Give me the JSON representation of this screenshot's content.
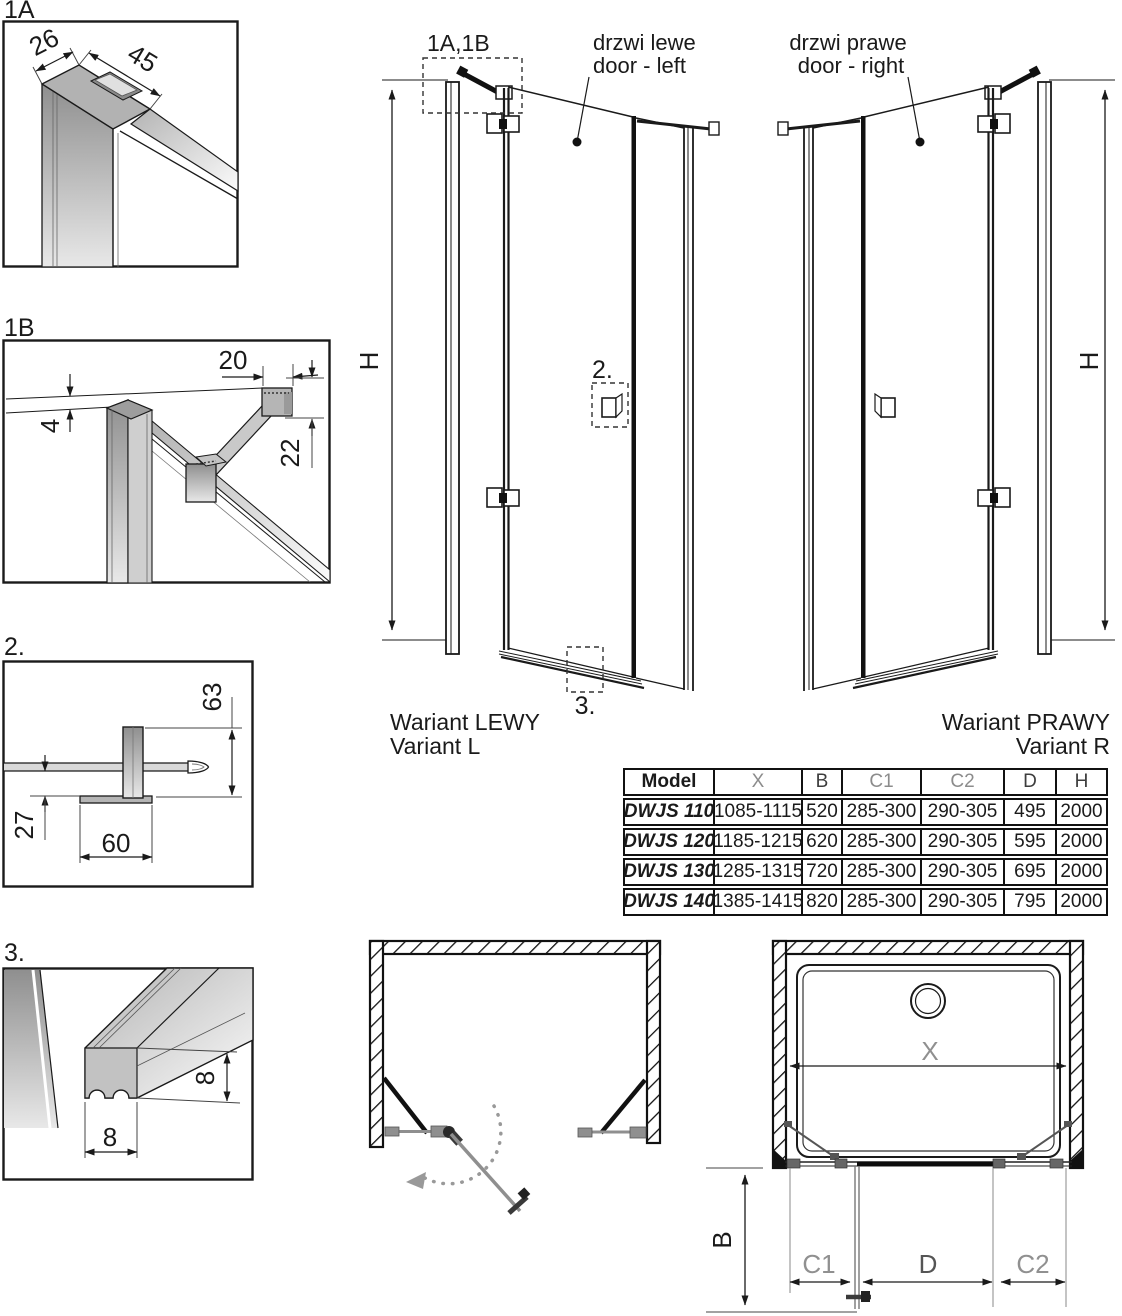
{
  "details": {
    "d1a": {
      "label": "1A",
      "dim_width": "26",
      "dim_depth": "45"
    },
    "d1b": {
      "label": "1B",
      "dim_top": "20",
      "dim_gap": "4",
      "dim_height": "22"
    },
    "d2": {
      "label": "2.",
      "dim_height": "63",
      "dim_offset": "27",
      "dim_width": "60"
    },
    "d3": {
      "label": "3.",
      "dim_height": "8",
      "dim_width": "8"
    }
  },
  "elevation_left": {
    "callout": "1A,1B",
    "door_label_line1": "drzwi lewe",
    "door_label_line2": "door - left",
    "handle_callout": "2.",
    "sill_callout": "3.",
    "height_label": "H",
    "variant_line1": "Wariant LEWY",
    "variant_line2": "Variant L"
  },
  "elevation_right": {
    "door_label_line1": "drzwi prawe",
    "door_label_line2": "door - right",
    "height_label": "H",
    "variant_line1": "Wariant PRAWY",
    "variant_line2": "Variant R"
  },
  "spec_table": {
    "headers": [
      "Model",
      "X",
      "B",
      "C1",
      "C2",
      "D",
      "H"
    ],
    "rows": [
      [
        "DWJS 110",
        "1085-1115",
        "520",
        "285-300",
        "290-305",
        "495",
        "2000"
      ],
      [
        "DWJS 120",
        "1185-1215",
        "620",
        "285-300",
        "290-305",
        "595",
        "2000"
      ],
      [
        "DWJS 130",
        "1285-1315",
        "720",
        "285-300",
        "290-305",
        "695",
        "2000"
      ],
      [
        "DWJS 140",
        "1385-1415",
        "820",
        "285-300",
        "290-305",
        "795",
        "2000"
      ]
    ]
  },
  "plan_right": {
    "dim_x": "X",
    "dim_b": "B",
    "dim_c1": "C1",
    "dim_d": "D",
    "dim_c2": "C2"
  },
  "colors": {
    "line": "#1a1a1a",
    "dim_muted": "#909090",
    "metal": "#b3b3b3",
    "table_border": "#111111"
  }
}
